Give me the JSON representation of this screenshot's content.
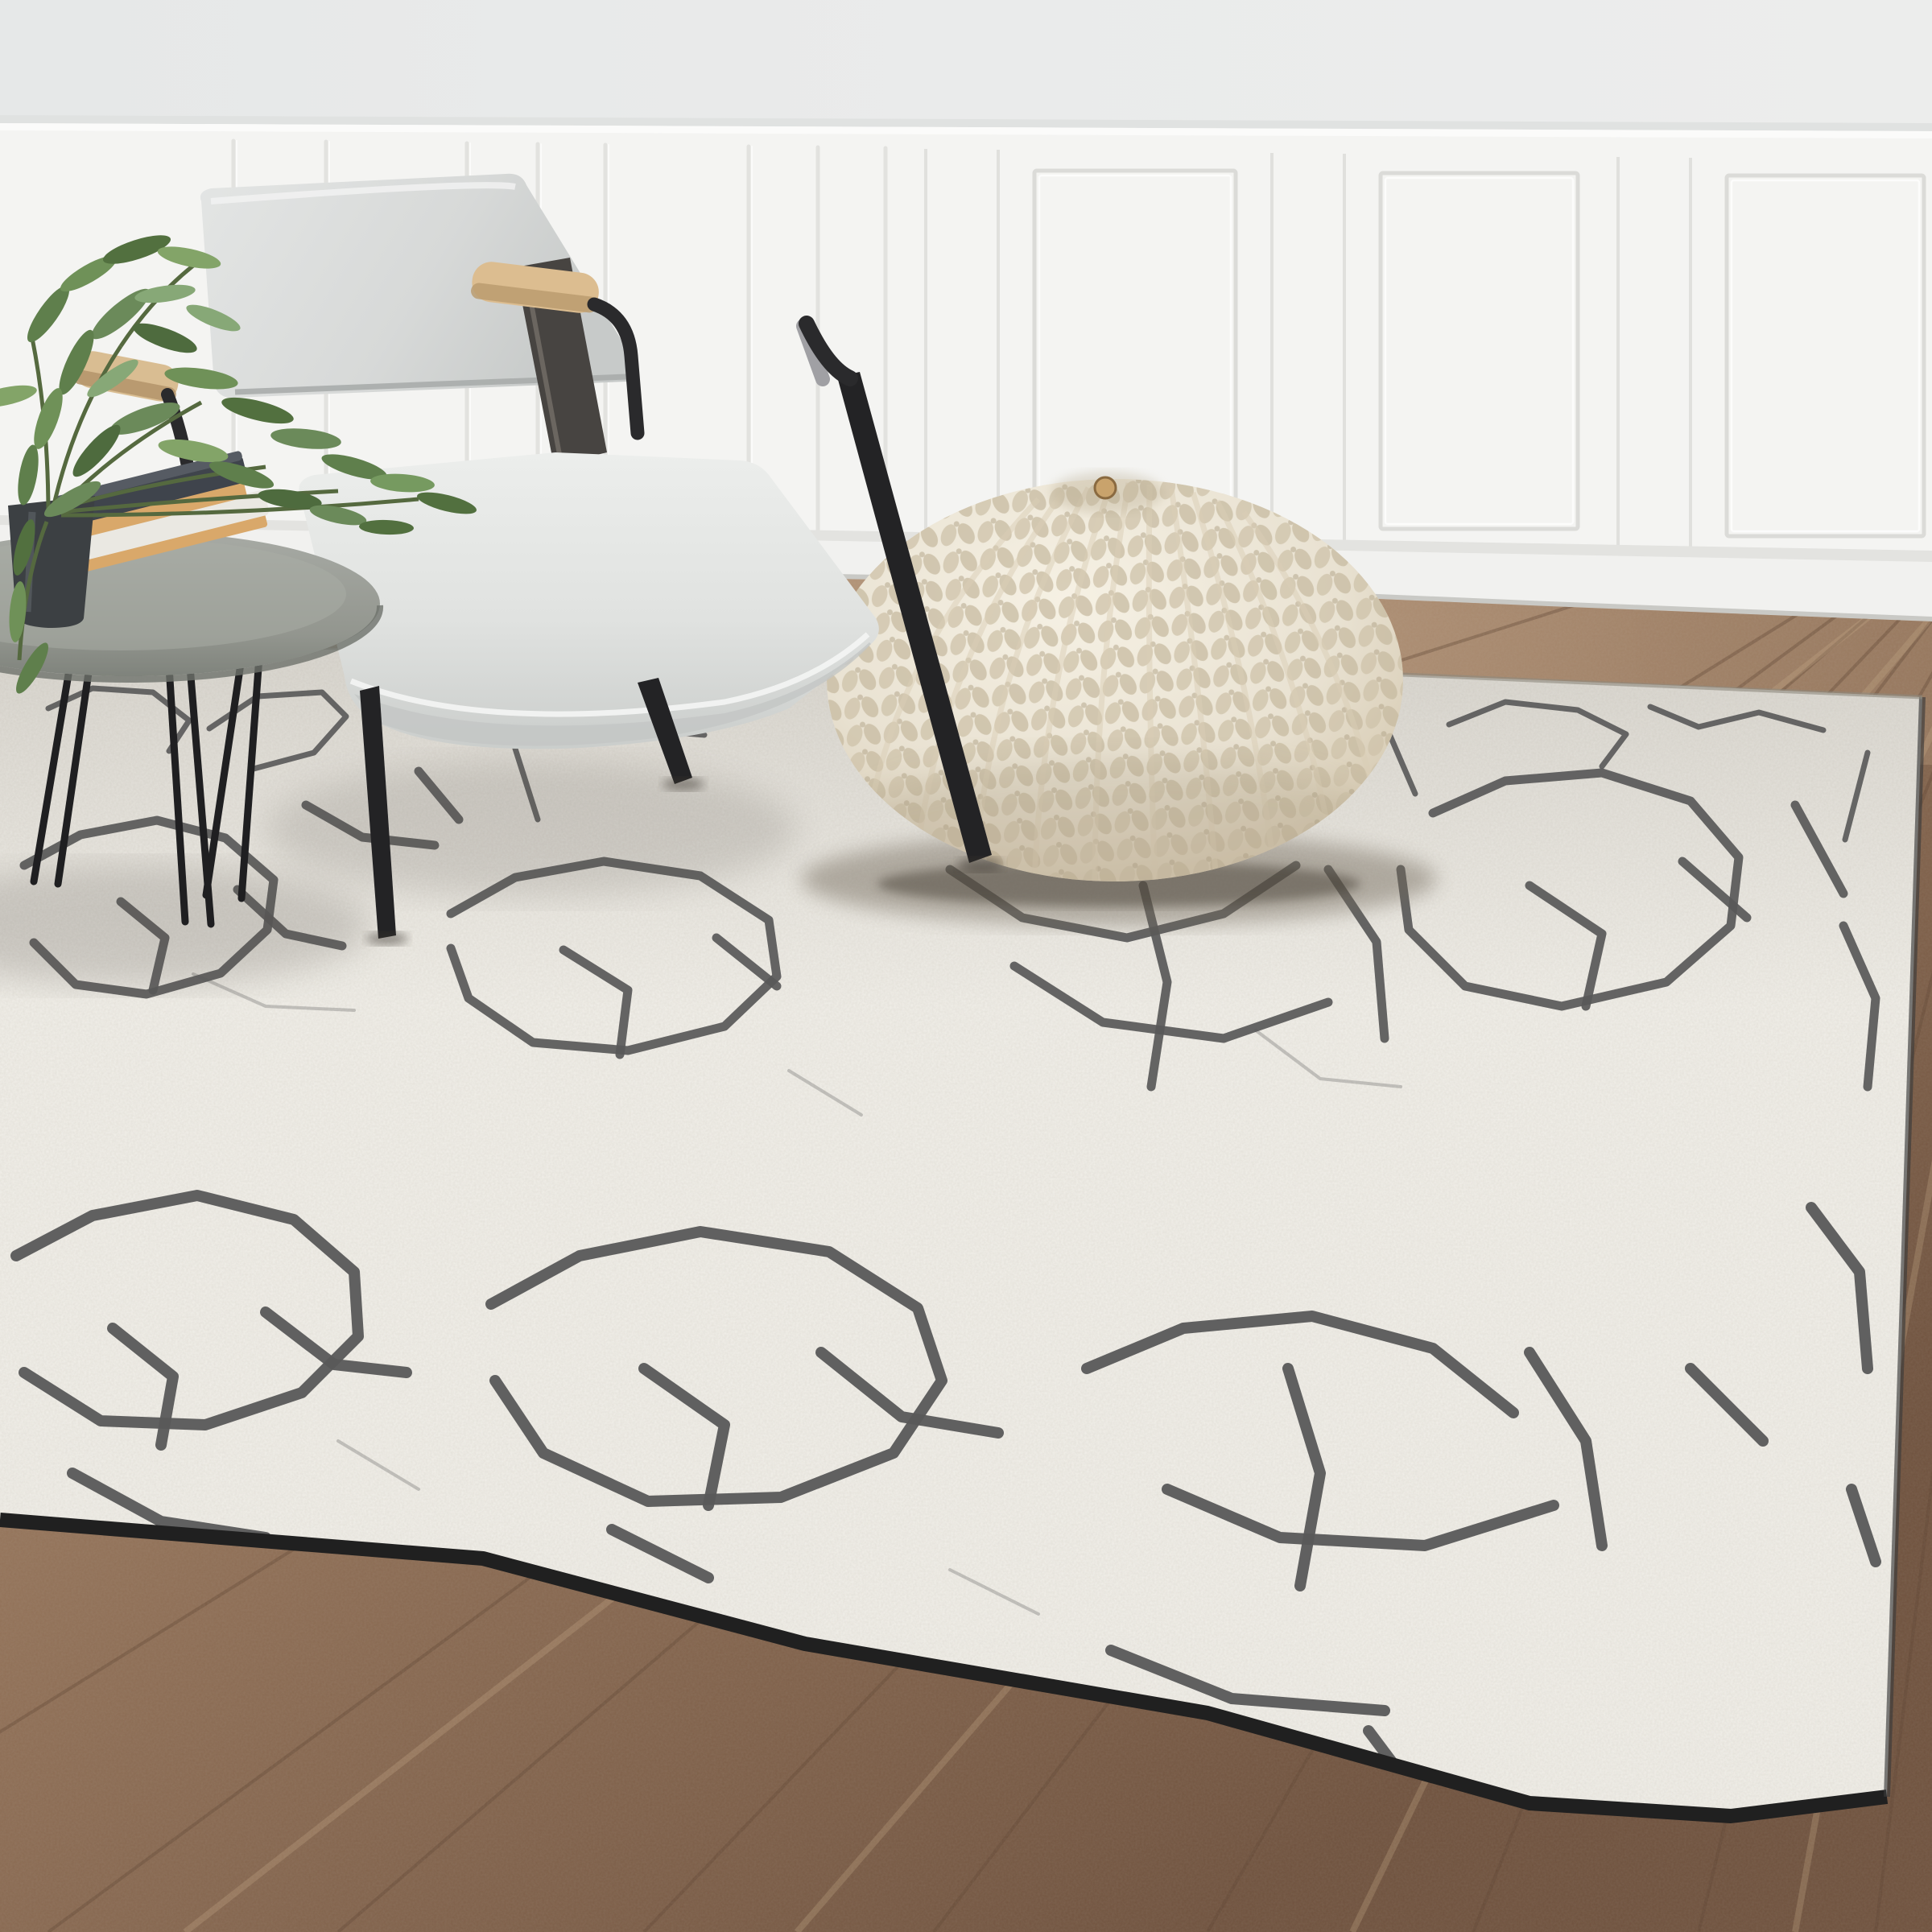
{
  "meta": {
    "title": "Living-room photograph: ivory area rug with abstract gray crackle pattern",
    "image_type": "product / interior photograph",
    "interactive_elements": "none"
  },
  "scene": {
    "room": {
      "upper_wall": {
        "label": "plain upper wall",
        "color": "#e8eaea"
      },
      "wainscot": {
        "label": "white panelled wainscoting",
        "color": "#f4f4f2",
        "panel_count_visible": 4,
        "batten_section": "left",
        "molding_shadow": "#dcdcd9"
      },
      "baseboard": {
        "label": "white baseboard",
        "color": "#f1f1ef"
      },
      "floor": {
        "label": "brown wood plank floor",
        "color_light": "#ab8d70",
        "color_dark": "#6f523e",
        "plank_line": "#5e4431"
      }
    },
    "objects": {
      "rug": {
        "label": "large ivory shag area rug with hand-drawn gray crackle / branch pattern",
        "base_color": "#f1efe9",
        "speckle_color": "#b7b1a6",
        "crack_color": "#585858",
        "edge_binding_color": "#202020"
      },
      "armchair": {
        "label": "light gray leather armchair with black metal frame and beech armrests",
        "upholstery_color": "#dcdedd",
        "seat_color": "#e4e5e3",
        "armrest_wood_color": "#dcbd90",
        "frame_color": "#2a2a2c",
        "chrome_accent": "#a0a0a4"
      },
      "pouf": {
        "label": "cream chunky-knit round pouf ottoman",
        "base_color": "#e9e2d2",
        "knit_shadow_color": "#cfc3ab",
        "button_color": "#c9a36c"
      },
      "side_table": {
        "label": "round gray coffee table with black hairpin legs",
        "top_color": "#9b9e99",
        "leg_color": "#1f1f21"
      },
      "books": {
        "label": "two books stacked on table",
        "top_cover_color": "#3f444c",
        "bottom_cover_color": "#eae8e2",
        "page_edge_color": "#d9a86a"
      },
      "plant": {
        "label": "green olive-style plant in dark pot",
        "leaf_color": "#6b8a5a",
        "pot_color": "#3c4043"
      }
    }
  }
}
